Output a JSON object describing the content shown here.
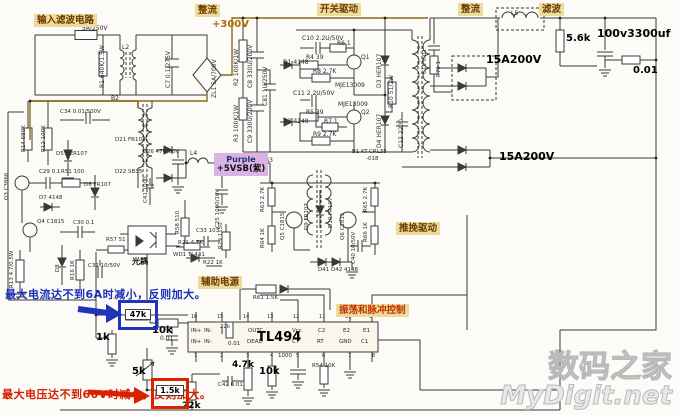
{
  "sections": {
    "input_filter": "输入滤波电路",
    "rectify_top": "整流",
    "switch_drive": "开关驱动",
    "rectify_right": "整流",
    "filter_right": "滤波",
    "aux_power": "辅助电源",
    "push_pull_drive": "推挽驱动",
    "osc_pulse_ctrl": "振荡和脉冲控制",
    "optocoupler": "光耦"
  },
  "rails": {
    "v300": "+300V",
    "standby_line1": "Purple",
    "standby_line2": "+5VSB(紫)"
  },
  "annotations": {
    "current_note": "最大电流达不到6A时减小，反则加大。",
    "voltage_note": "最大电压达不到60V时减小，反则加大。",
    "current_boxed_value": "47k",
    "voltage_boxed_value": "1.5k"
  },
  "ic": {
    "name": "TL494"
  },
  "watermark": {
    "line1": "数码之家",
    "line2": "MyDigit.net"
  },
  "colors": {
    "highlight_bg": "#ecdb9b",
    "annotation_blue": "#1a2fb8",
    "annotation_red": "#d42000",
    "standby_purple_bg": "#d9b3e6",
    "rail_label_color": "#b06a00",
    "wire_brown": "#8a6a18",
    "watermark_gray": "#b9b9b9"
  },
  "components": [
    {
      "t": "5A/250V",
      "x": 82,
      "y": 26
    },
    {
      "t": "R1 640K/1.5W",
      "x": 100,
      "y": 88,
      "o": "v"
    },
    {
      "t": "L2",
      "x": 122,
      "y": 45
    },
    {
      "t": "C7 0.1/275V",
      "x": 166,
      "y": 88,
      "o": "v"
    },
    {
      "t": "ZL1 5A/700V",
      "x": 212,
      "y": 98,
      "o": "v"
    },
    {
      "t": "R2 100K/1W",
      "x": 234,
      "y": 86,
      "o": "v"
    },
    {
      "t": "C8 330U/200V",
      "x": 248,
      "y": 88,
      "o": "v"
    },
    {
      "t": "C81 1U/250V",
      "x": 263,
      "y": 106,
      "o": "v"
    },
    {
      "t": "R3 100K/1W",
      "x": 234,
      "y": 142,
      "o": "v"
    },
    {
      "t": "C9 330U/200V",
      "x": 248,
      "y": 143,
      "o": "v"
    },
    {
      "t": "C10 2.2U/50V",
      "x": 302,
      "y": 36
    },
    {
      "t": "D1 4148",
      "x": 283,
      "y": 60
    },
    {
      "t": "R4 39",
      "x": 306,
      "y": 55
    },
    {
      "t": "R6 1",
      "x": 337,
      "y": 41
    },
    {
      "t": "R8 2.7K",
      "x": 313,
      "y": 69
    },
    {
      "t": "Q1",
      "x": 361,
      "y": 55
    },
    {
      "t": "MJE13009",
      "x": 335,
      "y": 83
    },
    {
      "t": "D3 HER107",
      "x": 377,
      "y": 88,
      "o": "v"
    },
    {
      "t": "C11 2.2U/50V",
      "x": 293,
      "y": 91
    },
    {
      "t": "MJE13009",
      "x": 338,
      "y": 102
    },
    {
      "t": "R5 39",
      "x": 306,
      "y": 110
    },
    {
      "t": "D2 4148",
      "x": 283,
      "y": 119
    },
    {
      "t": "R7 1",
      "x": 324,
      "y": 119
    },
    {
      "t": "Q2",
      "x": 361,
      "y": 110
    },
    {
      "t": "R9 2.7K",
      "x": 313,
      "y": 132
    },
    {
      "t": "D4 HER107",
      "x": 377,
      "y": 148,
      "o": "v"
    },
    {
      "t": "R10 51/2W",
      "x": 389,
      "y": 108,
      "o": "v"
    },
    {
      "t": "C12 2200",
      "x": 399,
      "y": 148,
      "o": "v"
    },
    {
      "t": "B1 KT-CRL35",
      "x": 352,
      "y": 150,
      "s": 5.5
    },
    {
      "t": "-018",
      "x": 366,
      "y": 157,
      "s": 5.5
    },
    {
      "t": "C15 0.01",
      "x": 423,
      "y": 74,
      "o": "v",
      "s": 5.5
    },
    {
      "t": "R70 1",
      "x": 437,
      "y": 77,
      "o": "v",
      "s": 5.5
    },
    {
      "t": "15A200V",
      "x": 486,
      "y": 54,
      "b": 1,
      "s": 11
    },
    {
      "t": "L5",
      "x": 511,
      "y": 11,
      "s": 6
    },
    {
      "t": "5.6k",
      "x": 566,
      "y": 34,
      "b": 1,
      "s": 10
    },
    {
      "t": "100v3300uf",
      "x": 597,
      "y": 28,
      "b": 1,
      "s": 11
    },
    {
      "t": "0.01",
      "x": 633,
      "y": 66,
      "b": 1,
      "s": 10
    },
    {
      "t": "15A200V",
      "x": 499,
      "y": 151,
      "b": 1,
      "s": 11
    },
    {
      "t": "R14 680K",
      "x": 22,
      "y": 152,
      "o": "v",
      "s": 5.5
    },
    {
      "t": "R12 100K",
      "x": 42,
      "y": 152,
      "o": "v",
      "s": 5.5
    },
    {
      "t": "C34 0.01/500V",
      "x": 60,
      "y": 110,
      "s": 5.5
    },
    {
      "t": "D5 HER107",
      "x": 56,
      "y": 152,
      "s": 5.5
    },
    {
      "t": "B2",
      "x": 111,
      "y": 96
    },
    {
      "t": "D21 FR103",
      "x": 115,
      "y": 138,
      "s": 5.5
    },
    {
      "t": "C26 47U/50V",
      "x": 143,
      "y": 150,
      "s": 5.5
    },
    {
      "t": "D22 SB35",
      "x": 115,
      "y": 170,
      "s": 5.5
    },
    {
      "t": "C41 1000",
      "x": 144,
      "y": 203,
      "o": "v",
      "s": 5.5
    },
    {
      "t": "L4",
      "x": 190,
      "y": 151,
      "s": 6
    },
    {
      "t": "C25 1000/10V",
      "x": 216,
      "y": 228,
      "o": "v",
      "s": 5.5
    },
    {
      "t": "B3",
      "x": 265,
      "y": 158,
      "s": 6
    },
    {
      "t": "Q3 C3866",
      "x": 5,
      "y": 200,
      "o": "v",
      "s": 5.5
    },
    {
      "t": "C29 0.1",
      "x": 39,
      "y": 170,
      "s": 5.5
    },
    {
      "t": "R51 100",
      "x": 61,
      "y": 170,
      "s": 5.5
    },
    {
      "t": "D7 4148",
      "x": 39,
      "y": 196,
      "s": 5.5
    },
    {
      "t": "D6 FR107",
      "x": 84,
      "y": 183,
      "s": 5.5
    },
    {
      "t": "Q4 C1815",
      "x": 37,
      "y": 220,
      "s": 5.5
    },
    {
      "t": "C30 0.1",
      "x": 73,
      "y": 221,
      "s": 5.5
    },
    {
      "t": "R13 4.7/0.5W",
      "x": 10,
      "y": 288,
      "o": "v",
      "s": 5.5
    },
    {
      "t": "D8",
      "x": 56,
      "y": 272,
      "o": "v",
      "s": 5.5
    },
    {
      "t": "R16 1K",
      "x": 71,
      "y": 280,
      "o": "v",
      "s": 5.5
    },
    {
      "t": "C32 10/50V",
      "x": 88,
      "y": 264,
      "s": 5.5
    },
    {
      "t": "R57 51",
      "x": 106,
      "y": 238,
      "s": 5.5
    },
    {
      "t": "R58 510",
      "x": 176,
      "y": 234,
      "o": "v",
      "s": 5.5
    },
    {
      "t": "C33 103",
      "x": 196,
      "y": 229,
      "s": 5.5
    },
    {
      "t": "R29 1150",
      "x": 219,
      "y": 249,
      "o": "v",
      "s": 5.5
    },
    {
      "t": "R21 4.7K",
      "x": 178,
      "y": 241,
      "s": 5.5
    },
    {
      "t": "WD1 TL431",
      "x": 173,
      "y": 253,
      "s": 5.5
    },
    {
      "t": "R22 1K",
      "x": 203,
      "y": 261,
      "s": 5.5
    },
    {
      "t": "R63 2.7K",
      "x": 261,
      "y": 212,
      "o": "v",
      "s": 5.5
    },
    {
      "t": "R64 1K",
      "x": 261,
      "y": 248,
      "o": "v",
      "s": 5.5
    },
    {
      "t": "Q5 C1815",
      "x": 281,
      "y": 240,
      "o": "v",
      "s": 5.5
    },
    {
      "t": "D9 FR107",
      "x": 305,
      "y": 230,
      "o": "v",
      "s": 5.5
    },
    {
      "t": "D10 FR107",
      "x": 329,
      "y": 228,
      "o": "v",
      "s": 5.5
    },
    {
      "t": "Q6 C1815",
      "x": 341,
      "y": 240,
      "o": "v",
      "s": 5.5
    },
    {
      "t": "R65 2.7K",
      "x": 364,
      "y": 212,
      "o": "v",
      "s": 5.5
    },
    {
      "t": "R66 1K",
      "x": 364,
      "y": 242,
      "o": "v",
      "s": 5.5
    },
    {
      "t": "C40 10/50V",
      "x": 352,
      "y": 264,
      "o": "v",
      "s": 5.5
    },
    {
      "t": "D41 D42 4148",
      "x": 318,
      "y": 268,
      "s": 5.5
    },
    {
      "t": "R61 1.5K",
      "x": 253,
      "y": 296,
      "s": 5.5
    },
    {
      "t": "1k",
      "x": 96,
      "y": 333,
      "b": 1,
      "s": 10
    },
    {
      "t": "10k",
      "x": 152,
      "y": 326,
      "b": 1,
      "s": 10
    },
    {
      "t": "0.01",
      "x": 160,
      "y": 336,
      "s": 6
    },
    {
      "t": "5k",
      "x": 132,
      "y": 367,
      "b": 1,
      "s": 10
    },
    {
      "t": "22k",
      "x": 182,
      "y": 402,
      "b": 1,
      "s": 9
    },
    {
      "t": "4.7k",
      "x": 232,
      "y": 361,
      "b": 1,
      "s": 9
    },
    {
      "t": "C42 0.01",
      "x": 218,
      "y": 383,
      "s": 5.5
    },
    {
      "t": "10k",
      "x": 259,
      "y": 367,
      "b": 1,
      "s": 10
    },
    {
      "t": "1000",
      "x": 278,
      "y": 354,
      "s": 5.5
    },
    {
      "t": "R54 10K",
      "x": 312,
      "y": 364,
      "s": 5.5
    },
    {
      "t": "22k",
      "x": 220,
      "y": 325,
      "s": 5.5
    },
    {
      "t": "0.01",
      "x": 228,
      "y": 342,
      "s": 5.5
    },
    {
      "t": "IN+",
      "x": 191,
      "y": 329,
      "n": "ic-pin-label",
      "s": 5.5
    },
    {
      "t": "IN-",
      "x": 204,
      "y": 329,
      "n": "ic-pin-label",
      "s": 5.5
    },
    {
      "t": "IN+",
      "x": 191,
      "y": 340,
      "n": "ic-pin-label",
      "s": 5.5
    },
    {
      "t": "IN-",
      "x": 204,
      "y": 340,
      "n": "ic-pin-label",
      "s": 5.5
    },
    {
      "t": "OUTC",
      "x": 248,
      "y": 329,
      "n": "ic-pin-label",
      "s": 5.5
    },
    {
      "t": "DEAD",
      "x": 247,
      "y": 340,
      "n": "ic-pin-label",
      "s": 5.5
    },
    {
      "t": "Vcc",
      "x": 292,
      "y": 329,
      "n": "ic-pin-label",
      "s": 5.5
    },
    {
      "t": "CT",
      "x": 292,
      "y": 340,
      "n": "ic-pin-label",
      "s": 5.5
    },
    {
      "t": "C2",
      "x": 318,
      "y": 329,
      "n": "ic-pin-label",
      "s": 5.5
    },
    {
      "t": "RT",
      "x": 317,
      "y": 340,
      "n": "ic-pin-label",
      "s": 5.5
    },
    {
      "t": "E2",
      "x": 343,
      "y": 329,
      "n": "ic-pin-label",
      "s": 5.5
    },
    {
      "t": "GND",
      "x": 339,
      "y": 340,
      "n": "ic-pin-label",
      "s": 5.5
    },
    {
      "t": "E1",
      "x": 363,
      "y": 329,
      "n": "ic-pin-label",
      "s": 5.5
    },
    {
      "t": "C1",
      "x": 361,
      "y": 340,
      "n": "ic-pin-label",
      "s": 5.5
    },
    {
      "t": "16",
      "x": 191,
      "y": 315,
      "n": "ic-pin-number",
      "s": 5
    },
    {
      "t": "15",
      "x": 217,
      "y": 315,
      "n": "ic-pin-number",
      "s": 5
    },
    {
      "t": "14",
      "x": 243,
      "y": 315,
      "n": "ic-pin-number",
      "s": 5
    },
    {
      "t": "13",
      "x": 267,
      "y": 315,
      "n": "ic-pin-number",
      "s": 5
    },
    {
      "t": "12",
      "x": 293,
      "y": 315,
      "n": "ic-pin-number",
      "s": 5
    },
    {
      "t": "11",
      "x": 319,
      "y": 315,
      "n": "ic-pin-number",
      "s": 5
    },
    {
      "t": "10",
      "x": 345,
      "y": 315,
      "n": "ic-pin-number",
      "s": 5
    },
    {
      "t": "9",
      "x": 369,
      "y": 315,
      "n": "ic-pin-number",
      "s": 5
    },
    {
      "t": "1",
      "x": 194,
      "y": 354,
      "n": "ic-pin-number",
      "s": 5
    },
    {
      "t": "2",
      "x": 220,
      "y": 354,
      "n": "ic-pin-number",
      "s": 5
    },
    {
      "t": "3",
      "x": 246,
      "y": 354,
      "n": "ic-pin-number",
      "s": 5
    },
    {
      "t": "4",
      "x": 270,
      "y": 354,
      "n": "ic-pin-number",
      "s": 5
    },
    {
      "t": "5",
      "x": 296,
      "y": 354,
      "n": "ic-pin-number",
      "s": 5
    },
    {
      "t": "6",
      "x": 322,
      "y": 354,
      "n": "ic-pin-number",
      "s": 5
    },
    {
      "t": "7",
      "x": 348,
      "y": 354,
      "n": "ic-pin-number",
      "s": 5
    },
    {
      "t": "8",
      "x": 372,
      "y": 354,
      "n": "ic-pin-number",
      "s": 5
    }
  ]
}
